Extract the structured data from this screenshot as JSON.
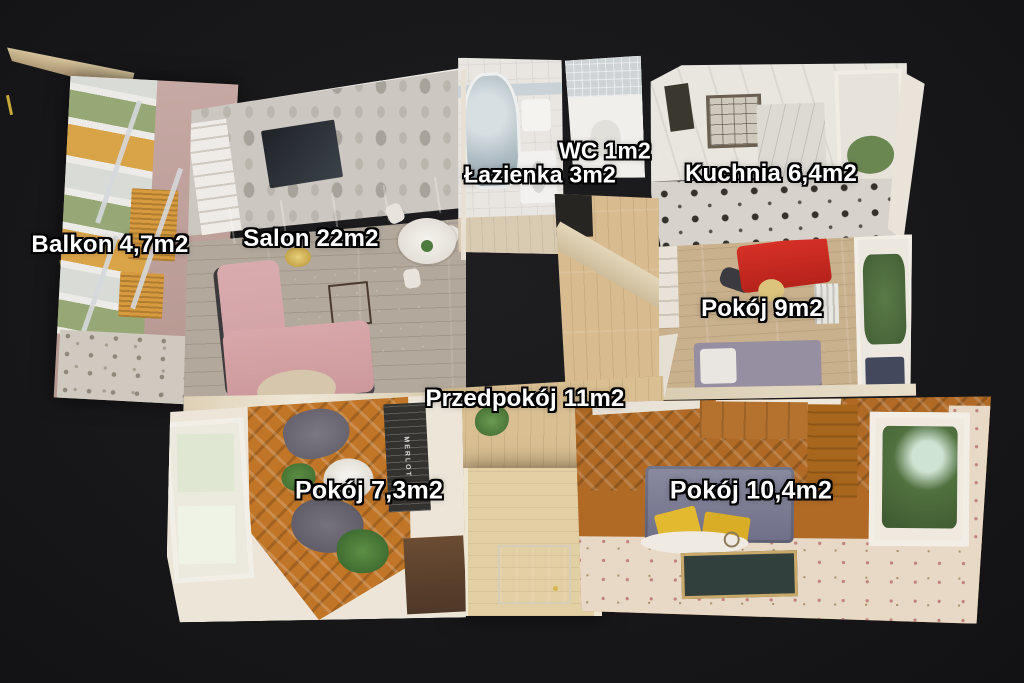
{
  "scene": {
    "description": "3D dollhouse top-down scan of an apartment floor plan",
    "background_color": "#18181a",
    "label_text_color": "#ffffff",
    "label_outline_color": "#000000"
  },
  "rooms": [
    {
      "id": "balkon",
      "label": "Balkon 4,7m2"
    },
    {
      "id": "salon",
      "label": "Salon 22m2"
    },
    {
      "id": "wc",
      "label": "WC 1m2"
    },
    {
      "id": "lazienka",
      "label": "Łazienka 3m2"
    },
    {
      "id": "kuchnia",
      "label": "Kuchnia 6,4m2"
    },
    {
      "id": "pokoj-9",
      "label": "Pokój 9m2"
    },
    {
      "id": "przedpokoj",
      "label": "Przedpokój 11m2"
    },
    {
      "id": "pokoj-7-3",
      "label": "Pokój 7,3m2"
    },
    {
      "id": "pokoj-10-4",
      "label": "Pokój 10,4m2"
    }
  ],
  "poster": {
    "text": "MERLOT"
  },
  "palette": {
    "road_dash_yellow": "#d9b73c",
    "sofa_pink": "#d8a7aa",
    "rug_teal": "#5d8d84",
    "cabinet_pink": "#d584a2",
    "desk_red": "#cf2b20",
    "pillow_yellow": "#e3b92f",
    "parquet_orange": "#c07527",
    "hall_wood": "#d9bf92"
  }
}
